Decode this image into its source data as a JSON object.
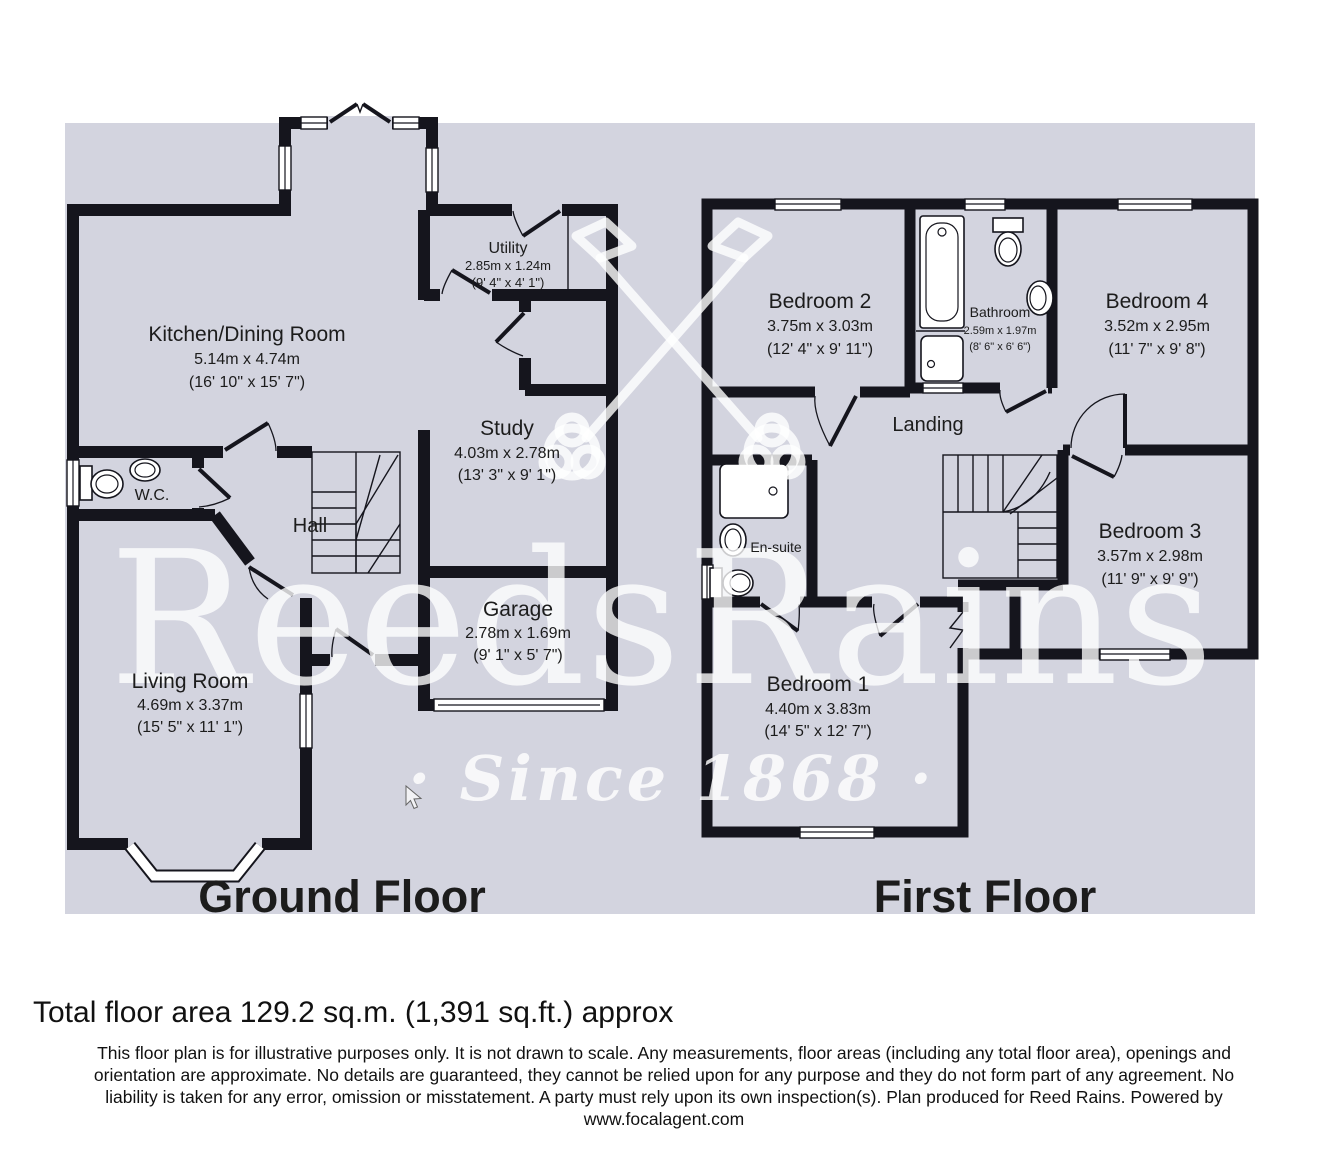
{
  "page": {
    "background": "#ffffff",
    "canvas_color": "#d3d4df",
    "wall_color": "#15151d"
  },
  "watermark": {
    "logo": "crossed-keys-emblem",
    "brand_word_1": "Reeds",
    "brand_word_2": "Rains",
    "tagline": "· Since 1868 ·"
  },
  "floors": [
    {
      "title": "Ground Floor",
      "rooms": [
        {
          "name": "Kitchen/Dining Room",
          "dim_m": "5.14m x 4.74m",
          "dim_ft": "(16' 10\" x 15' 7\")"
        },
        {
          "name": "Utility",
          "dim_m": "2.85m x 1.24m",
          "dim_ft": "(9' 4\" x 4' 1\")"
        },
        {
          "name": "Study",
          "dim_m": "4.03m x 2.78m",
          "dim_ft": "(13' 3\" x 9' 1\")"
        },
        {
          "name": "Garage",
          "dim_m": "2.78m x 1.69m",
          "dim_ft": "(9' 1\" x 5' 7\")"
        },
        {
          "name": "Hall"
        },
        {
          "name": "W.C."
        },
        {
          "name": "Living Room",
          "dim_m": "4.69m x 3.37m",
          "dim_ft": "(15' 5\" x 11' 1\")"
        }
      ]
    },
    {
      "title": "First Floor",
      "rooms": [
        {
          "name": "Bedroom 2",
          "dim_m": "3.75m x 3.03m",
          "dim_ft": "(12' 4\" x 9' 11\")"
        },
        {
          "name": "Bathroom",
          "dim_m": "2.59m x 1.97m",
          "dim_ft": "(8' 6\" x 6' 6\")"
        },
        {
          "name": "Bedroom 4",
          "dim_m": "3.52m x 2.95m",
          "dim_ft": "(11' 7\" x 9' 8\")"
        },
        {
          "name": "Landing"
        },
        {
          "name": "Bedroom 3",
          "dim_m": "3.57m x 2.98m",
          "dim_ft": "(11' 9\" x 9' 9\")"
        },
        {
          "name": "En-suite"
        },
        {
          "name": "Bedroom 1",
          "dim_m": "4.40m x 3.83m",
          "dim_ft": "(14' 5\" x 12' 7\")"
        }
      ]
    }
  ],
  "footer": {
    "total_area": "Total floor area 129.2 sq.m. (1,391 sq.ft.) approx",
    "disclaimer_lines": [
      "This floor plan is for illustrative purposes only. It is not drawn to scale. Any measurements, floor areas (including any total floor area), openings and",
      "orientation are approximate. No details are guaranteed, they cannot be relied upon for any purpose and they do not form part of any agreement. No",
      "liability is taken for any error, omission or misstatement. A party must rely upon its own inspection(s). Plan produced for Reed Rains. Powered by",
      "www.focalagent.com"
    ]
  }
}
